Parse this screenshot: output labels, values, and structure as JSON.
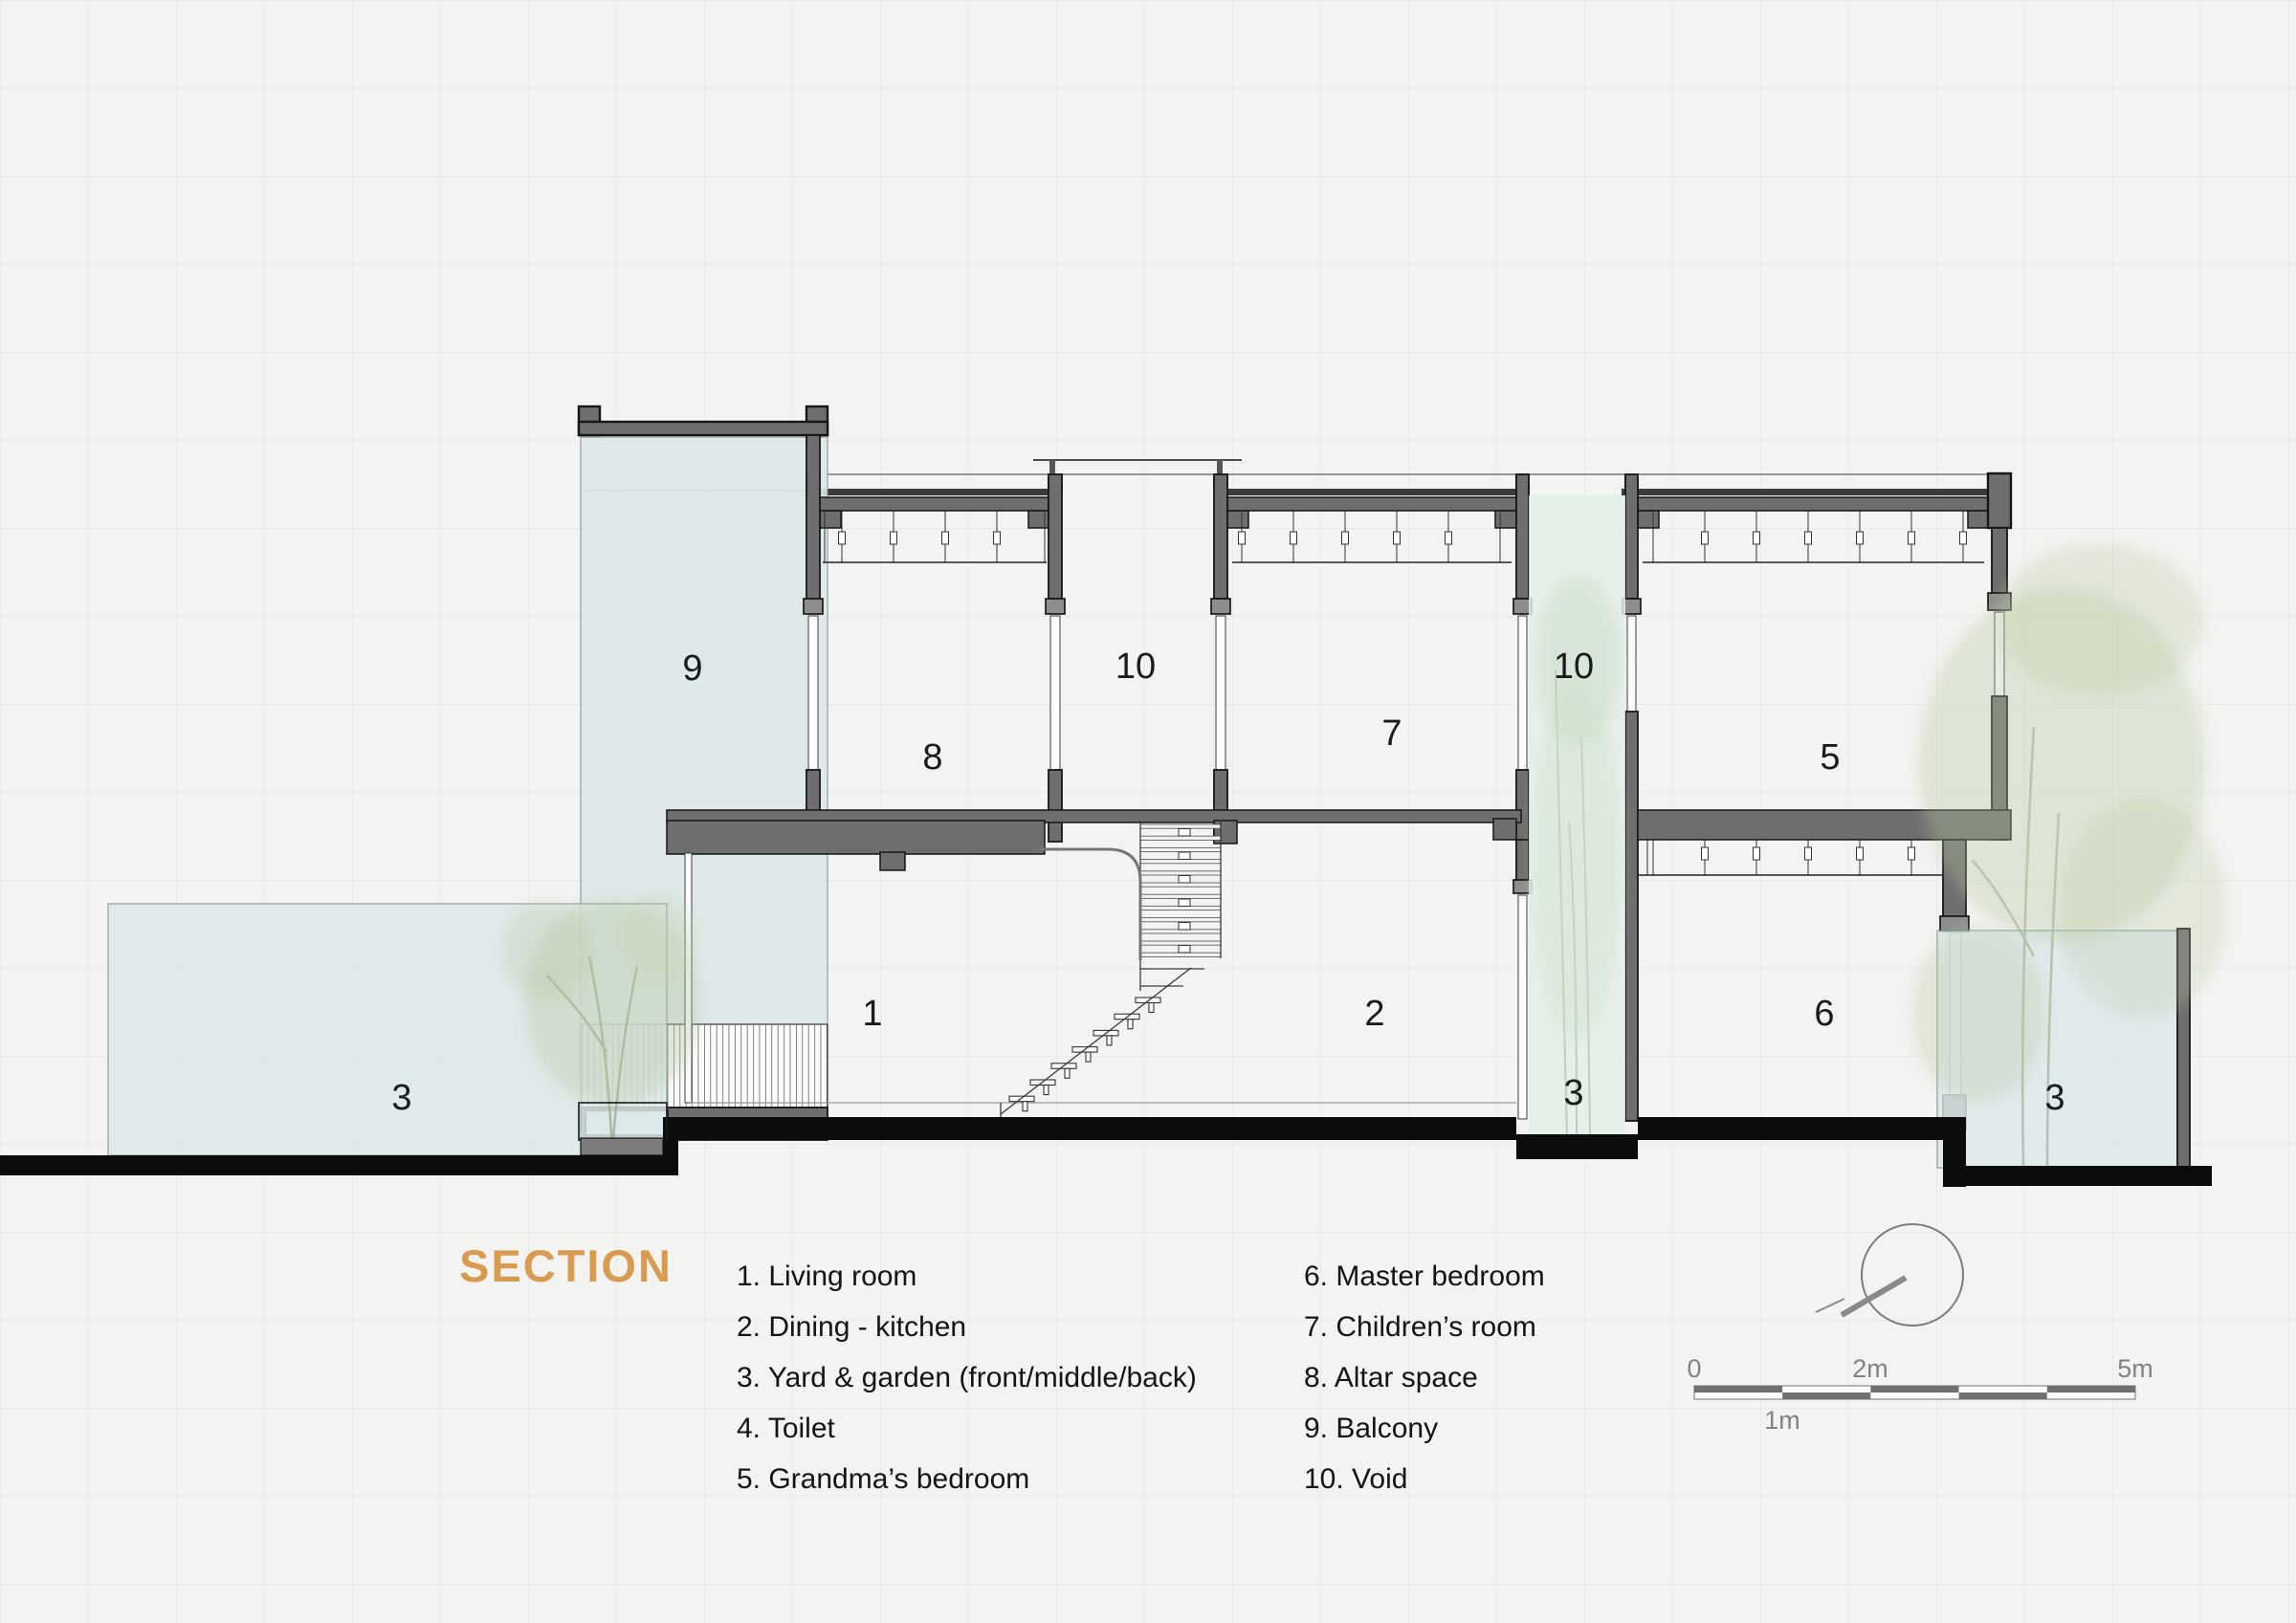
{
  "title": {
    "text": "SECTION",
    "color": "#d89b4f"
  },
  "legend": {
    "column1": [
      "1. Living room",
      "2. Dining - kitchen",
      "3. Yard & garden (front/middle/back)",
      "4. Toilet",
      "5. Grandma’s bedroom"
    ],
    "column2": [
      "6. Master bedroom",
      "7. Children’s room",
      "8. Altar space",
      "9. Balcony",
      "10. Void"
    ]
  },
  "room_labels": {
    "balcony": "9",
    "altar_space": "8",
    "void_left": "10",
    "children_room": "7",
    "void_right": "10",
    "grandma_bedroom": "5",
    "living_room": "1",
    "dining_kitchen": "2",
    "master_bedroom": "6",
    "yard_front": "3",
    "yard_middle": "3",
    "yard_back": "3"
  },
  "scale_bar": {
    "zero": "0",
    "two_m": "2m",
    "five_m": "5m",
    "one_m": "1m"
  },
  "colors": {
    "accent": "#d89b4f",
    "wall_gray": "#6e6e6e",
    "glass_blue": "#dde9ea",
    "glass_green": "#e2efe7",
    "ground_black": "#0c0c0c",
    "paper": "#f3f3f1"
  }
}
